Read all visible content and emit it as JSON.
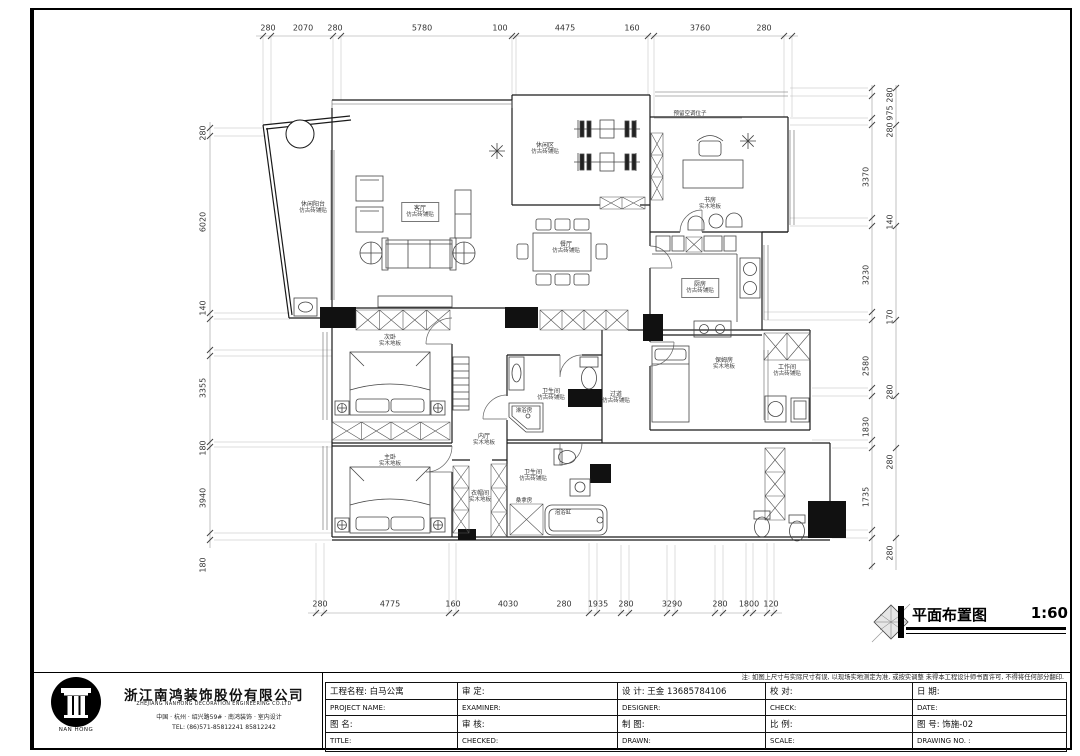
{
  "sheet": {
    "note": "注: 如图上尺寸与实际尺寸有误, 以现场实地测定为准, 或按实调整 未得本工程设计师书面许可, 不得将任何部分翻印.",
    "drawing_title": "平面布置图",
    "drawing_scale": "1:60"
  },
  "company": {
    "logo_text": "NAN HONG",
    "name_cn": "浙江南鸿装饰股份有限公司",
    "name_en": "ZHEJIANG NANHONG DECORATION ENGINEERING CO.LTD",
    "address": "中国 · 杭州 · 绍兴路59# · 南鸿装饰 · 室内设计",
    "tel": "TEL:  (86)571-85812241  85812242"
  },
  "titleblock": {
    "rows": [
      [
        "工程名程:  白马公寓",
        "审    定:",
        "设    计:  王金  13685784106",
        "校    对:",
        "日    期:"
      ],
      [
        "PROJECT NAME:",
        "EXAMINER:",
        "DESIGNER:",
        "CHECK:",
        "DATE:"
      ],
      [
        "图  名:",
        "审    核:",
        "制    图:",
        "比    例:",
        "图    号:      饰施-02"
      ],
      [
        "TITLE:",
        "CHECKED:",
        "DRAWN:",
        "SCALE:",
        "DRAWING NO. :"
      ]
    ]
  },
  "dimensions": {
    "top": [
      "280",
      "2070",
      "280",
      "5780",
      "100",
      "4475",
      "160",
      "3760",
      "280"
    ],
    "bottom": [
      "280",
      "4775",
      "160",
      "4030",
      "280",
      "1935",
      "280",
      "3290",
      "280",
      "1800",
      "120"
    ],
    "left": [
      "280",
      "6020",
      "140",
      "3355",
      "180",
      "3940",
      "180"
    ],
    "right": [
      "280",
      "975",
      "280",
      "3370",
      "140",
      "3230",
      "170",
      "2580",
      "280",
      "1830",
      "280",
      "1735",
      "280"
    ]
  },
  "rooms": [
    {
      "name": "休闲阳台",
      "finish": "仿古砖铺贴"
    },
    {
      "name": "客厅",
      "finish": "仿古砖铺贴"
    },
    {
      "name": "休闲区",
      "finish": "仿古砖铺贴"
    },
    {
      "name": "书房",
      "finish": "实木地板"
    },
    {
      "name": "餐厅",
      "finish": "仿古砖铺贴"
    },
    {
      "name": "厨房",
      "finish": "仿古砖铺贴"
    },
    {
      "name": "保姆房",
      "finish": "实木地板"
    },
    {
      "name": "工作间",
      "finish": "仿古砖铺贴"
    },
    {
      "name": "次卧",
      "finish": "实木地板"
    },
    {
      "name": "主卧",
      "finish": "实木地板"
    },
    {
      "name": "内厅",
      "finish": "实木地板"
    },
    {
      "name": "卫生间",
      "finish": "仿古砖铺贴"
    },
    {
      "name": "卫生间",
      "finish": "仿古砖铺贴"
    },
    {
      "name": "衣帽间",
      "finish": "实木地板"
    },
    {
      "name": "过道",
      "finish": "仿古砖铺贴"
    }
  ],
  "annotations": {
    "shower": "淋浴房",
    "sauna": "桑拿房",
    "bathtub": "泡浴缸",
    "reserve": "预留空调位子"
  }
}
